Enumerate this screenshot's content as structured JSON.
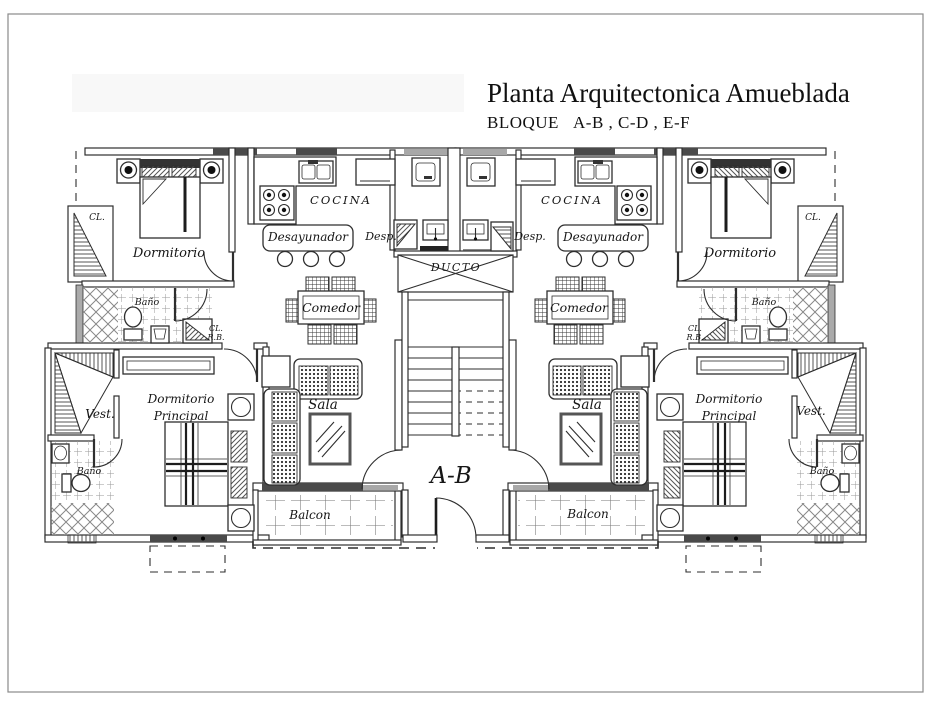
{
  "title": "Planta Arquitectonica Amueblada",
  "subtitle": {
    "word": "BLOQUE",
    "codes": "A-B , C-D , E-F"
  },
  "center": {
    "ducto": "DUCTO",
    "landing": "A-B"
  },
  "units": [
    {
      "side": "left",
      "dormitorio": "Dormitorio",
      "closet": "CL.",
      "bano": "Baño",
      "closet_rb_l1": "CL.",
      "closet_rb_l2": "R.B.",
      "cocina": "COCINA",
      "desayunador": "Desayunador",
      "despensa": "Desp.",
      "comedor": "Comedor",
      "sala": "Sala",
      "balcon": "Balcon",
      "vestidor": "Vest.",
      "bano_principal": "Baño",
      "dormitorio_principal_l1": "Dormitorio",
      "dormitorio_principal_l2": "Principal"
    },
    {
      "side": "right",
      "dormitorio": "Dormitorio",
      "closet": "CL.",
      "bano": "Baño",
      "closet_rb_l1": "CL.",
      "closet_rb_l2": "R.B.",
      "cocina": "COCINA",
      "desayunador": "Desayunador",
      "despensa": "Desp.",
      "comedor": "Comedor",
      "sala": "Sala",
      "balcon": "Balcon",
      "vestidor": "Vest.",
      "bano_principal": "Baño",
      "dormitorio_principal_l1": "Dormitorio",
      "dormitorio_principal_l2": "Principal"
    }
  ],
  "colors": {
    "line": "#2e2e2e",
    "window_dark": "#4a4a4a",
    "window_light": "#a8a8a8",
    "hatch": "#555555",
    "tile": "#999999",
    "border": "#8a8a8a"
  }
}
